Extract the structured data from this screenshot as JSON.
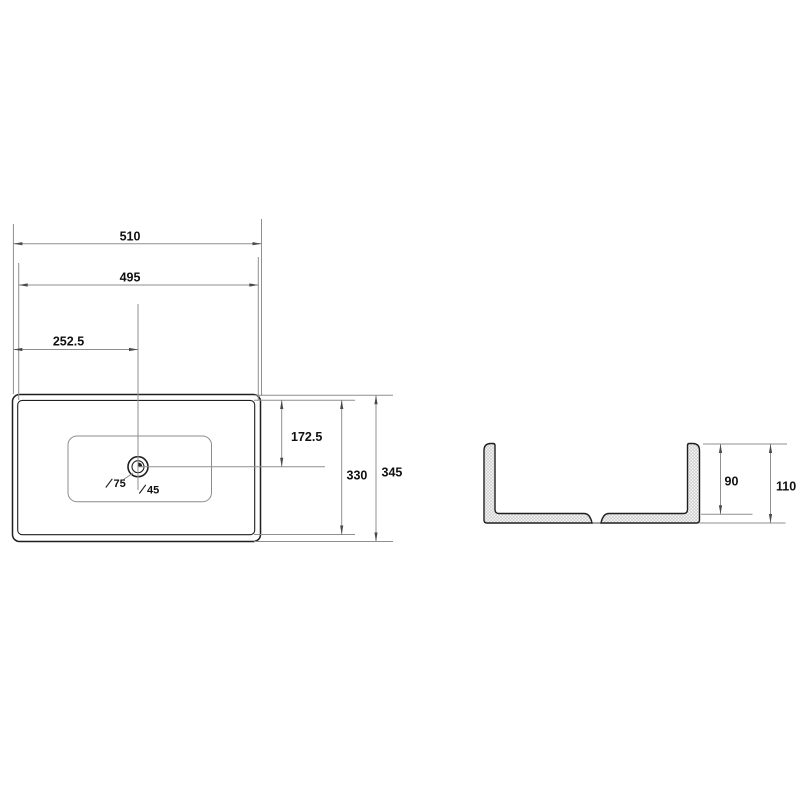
{
  "drawing_type": "basin technical drawing, two orthographic views",
  "colors": {
    "background": "#ffffff",
    "object_line": "#1f1f1f",
    "light_line": "#8c8c8c",
    "dimension_line": "#8f8f8f",
    "text": "#111111",
    "hatch": "#b3b3b3"
  },
  "top_view": {
    "name": "top view (plan) of rectangular basin with drain",
    "dims": {
      "overall_width": "510",
      "rim_width": "495",
      "drain_offset_x": "252.5",
      "drain_offset_y": "172.5",
      "rim_depth": "330",
      "overall_depth": "345",
      "drain_outer_dia": "75",
      "drain_inner_dia": "45"
    }
  },
  "side_view": {
    "name": "side section view with hatched walls",
    "dims": {
      "inner_depth": "90",
      "overall_height": "110"
    }
  }
}
